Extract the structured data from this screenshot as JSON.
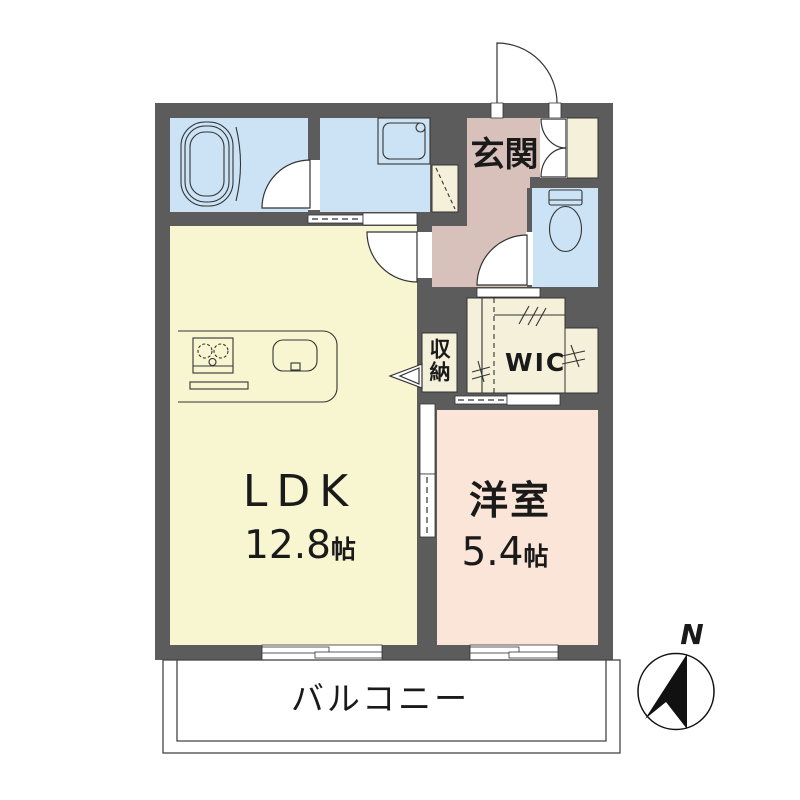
{
  "rooms": {
    "ldk": {
      "label": "LDK",
      "area": "12.8",
      "unit": "帖"
    },
    "bedroom": {
      "label": "洋室",
      "area": "5.4",
      "unit": "帖"
    },
    "entrance": {
      "label": "玄関"
    },
    "wic": {
      "label": "WIC"
    },
    "storage": {
      "label": "収納"
    },
    "balcony": {
      "label": "バルコニー"
    }
  },
  "compass": {
    "north": "N"
  },
  "colors": {
    "wall": "#5c5c5c",
    "wet_area_blue": "#cbe3f4",
    "ldk_yellow": "#f8f6d0",
    "hallway_pink": "#d8c0bb",
    "bedroom_pink": "#fae5d8",
    "closet_cream": "#f5f0da",
    "line": "#333333"
  },
  "icons": {
    "bathtub-icon": "nested rounded rectangles",
    "washing-machine-pan-icon": "square with corner circle",
    "toilet-icon": "tank and bowl",
    "stove-icon": "two burner circles",
    "sink-icon": "rounded rectangle with tap",
    "hanger-pipe-icon": "diagonal tick marks",
    "compass-north-arrow-icon": "black polygon arrow in circle"
  }
}
